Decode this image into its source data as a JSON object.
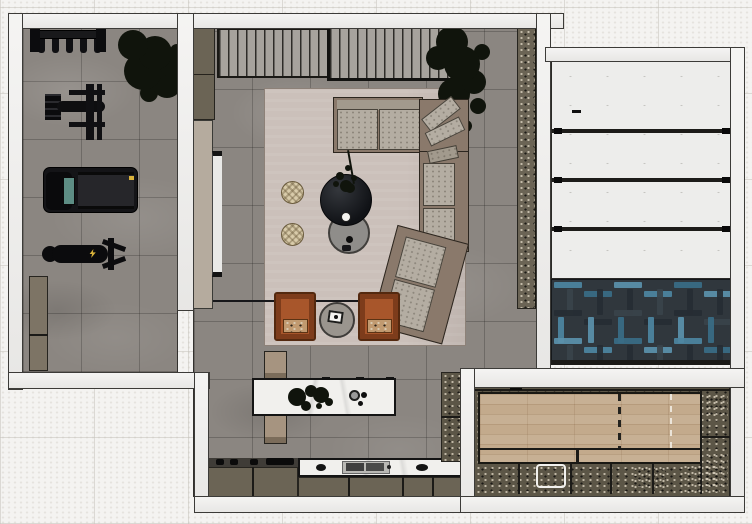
{
  "scene": {
    "view": "top-down-3d-floor-plan-render",
    "rooms": [
      {
        "name": "home-gym",
        "floor": "gray-stone-tile",
        "items": [
          "dumbbell-rack",
          "potted-tree",
          "cable-strength-machine",
          "treadmill",
          "weight-bench",
          "wall-cabinet"
        ]
      },
      {
        "name": "living-area",
        "floor": "gray-stone-tile",
        "items": [
          "tall-cabinets-northwest",
          "slatted-media-console",
          "framed-media-unit",
          "sliding-door-panel",
          "wall-tv",
          "potted-tree",
          "area-rug",
          "curved-sectional-sofa",
          "throw-pillows",
          "round-coffee-table-dark",
          "round-coffee-table-gray",
          "table-plant",
          "wicker-pouf-1",
          "wicker-pouf-2",
          "leather-lounge-chair-1",
          "leather-lounge-chair-2",
          "round-side-table",
          "tall-cabinet-column-east",
          "section-line"
        ]
      },
      {
        "name": "kitchen",
        "floor": "gray-stone-tile",
        "items": [
          "marble-island",
          "island-decor",
          "island-bench-north",
          "island-bench-south",
          "cooktop",
          "base-cabinets",
          "marble-counter-with-sink",
          "tall-cabinet"
        ]
      },
      {
        "name": "garage",
        "floor": "blue-herringbone-parquet",
        "items": [
          "white-panel-door-bays"
        ]
      },
      {
        "name": "games-room",
        "floor": "light-oak-planks",
        "items": [
          "perimeter-consoles",
          "lane-marking-dashed",
          "white-tray",
          "decor-clusters"
        ]
      }
    ]
  },
  "palette": {
    "exterior": "#f4f3f1",
    "wall": "#efeeec",
    "wallEdge": "#3c3b38",
    "floorGray": "#8b8681",
    "rug": "#cbc0ba",
    "sofaBase": "#8a796b",
    "cushion": "#b4ada2",
    "backBand": "#a29a8d",
    "pouf": "#d8cbaa",
    "armchair": "#a8562b",
    "armchairDark": "#7e3d1a",
    "armchairSeat": "#c19a70",
    "tableGray": "#8f8d8a",
    "sideTable": "#9a958e",
    "marble": "#f1f0ed",
    "steel": "#b9b8b4",
    "cabinetOlive": "#6b6455",
    "cabinetDark": "#5c5647",
    "cabinetTan": "#7d7465",
    "benchTan": "#a69480",
    "doorTan": "#b5ab9e",
    "tv": "#e9e9e7",
    "slat": "#a7a39d",
    "panel": "#ededeb",
    "lineDark": "#1b1a17",
    "herringboneBase": "#30373d",
    "blue1": "#4d85a1",
    "blue2": "#3a6c85",
    "blue3": "#5b91ab",
    "hbDark1": "#262d33",
    "hbDark2": "#3a434a",
    "wood": "#c3aa8c",
    "plant": "#10140c",
    "black": "#141416",
    "accentYellow": "#d9b23a",
    "white": "#f4f3f0"
  }
}
